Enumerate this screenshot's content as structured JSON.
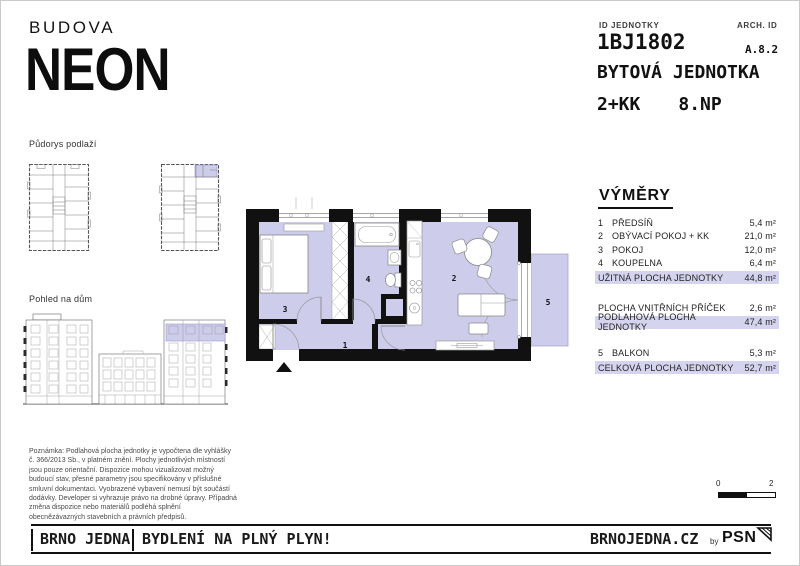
{
  "brand": {
    "building_label": "BUDOVA",
    "building_name": "NEON"
  },
  "header": {
    "id_label": "ID JEDNOTKY",
    "id_value": "1BJ1802",
    "arch_label": "ARCH. ID",
    "arch_value": "A.8.2",
    "unit_type": "BYTOVÁ JEDNOTKA",
    "disposition": "2+KK",
    "floor": "8.NP"
  },
  "sidebar": {
    "floorplan_title": "Půdorys podlaží",
    "elevation_title": "Pohled na dům",
    "note": "Poznámka: Podlahová plocha jednotky je vypočtena dle vyhlášky č. 366/2013 Sb., v platném znění. Plochy jednotlivých místností jsou pouze orientační. Dispozice mohou vizualizovat možný budoucí stav, přesné parametry jsou specifikovány v příslušné smluvní dokumentaci. Vyobrazené vybavení nemusí být součástí dodávky. Developer si vyhrazuje právo na drobné úpravy. Případná změna dispozice nebo materiálů podléhá splnění obecnězávazných stavebních a právních předpisů."
  },
  "plan": {
    "labels": [
      "1",
      "2",
      "3",
      "4",
      "5"
    ]
  },
  "areas": {
    "title": "VÝMĚRY",
    "rooms": [
      {
        "num": "1",
        "name": "PŘEDSÍŇ",
        "value": "5,4 m²"
      },
      {
        "num": "2",
        "name": "OBÝVACÍ POKOJ + KK",
        "value": "21,0 m²"
      },
      {
        "num": "3",
        "name": "POKOJ",
        "value": "12,0 m²"
      },
      {
        "num": "4",
        "name": "KOUPELNA",
        "value": "6,4 m²"
      }
    ],
    "usable_total": {
      "name": "UŽITNÁ  PLOCHA JEDNOTKY",
      "value": "44,8 m²"
    },
    "partitions": {
      "name": "PLOCHA VNITŘNÍCH PŘÍČEK",
      "value": "2,6 m²"
    },
    "floor_total": {
      "name": "PODLAHOVÁ PLOCHA JEDNOTKY",
      "value": "47,4 m²"
    },
    "balcony": {
      "num": "5",
      "name": "BALKON",
      "value": "5,3 m²"
    },
    "grand_total": {
      "name": "CELKOVÁ PLOCHA JEDNOTKY",
      "value": "52,7 m²"
    }
  },
  "scalebar": {
    "from": "0",
    "to": "2"
  },
  "footer": {
    "brand": "BRNO JEDNA",
    "tagline": "BYDLENÍ NA PLNÝ PLYN!",
    "website": "BRNOJEDNA.CZ",
    "by_label": "by",
    "logo_text": "PSN"
  },
  "colors": {
    "accent": "#cdccea",
    "highlight_row": "#d5d4ee",
    "wall": "#111111"
  }
}
